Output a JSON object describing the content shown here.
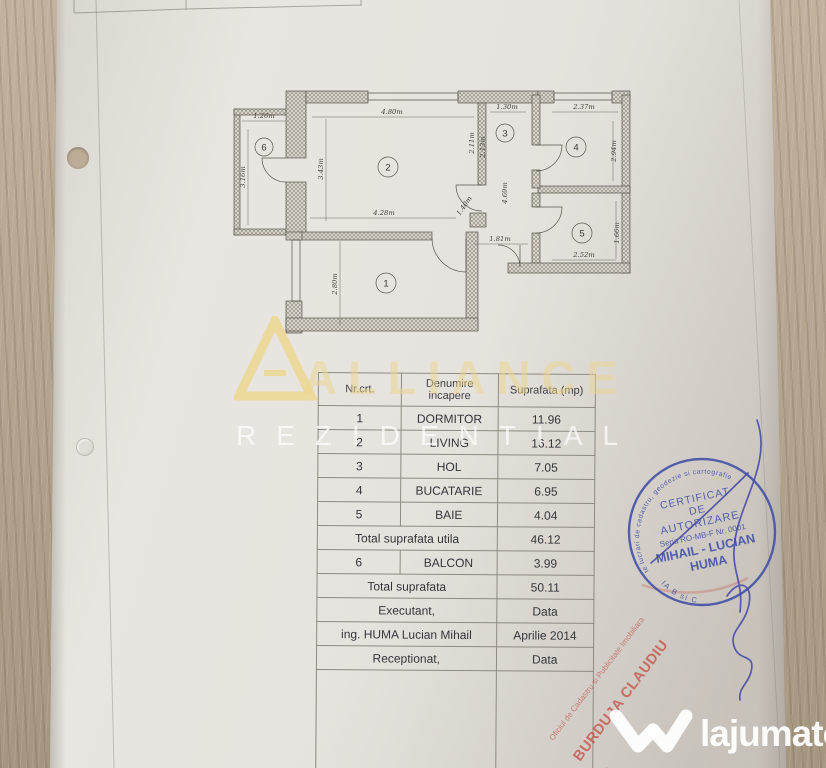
{
  "plan": {
    "rooms": [
      {
        "number": "1"
      },
      {
        "number": "2"
      },
      {
        "number": "3"
      },
      {
        "number": "4"
      },
      {
        "number": "5"
      },
      {
        "number": "6"
      }
    ],
    "dims": [
      {
        "label": "1.26m"
      },
      {
        "label": "3.16m"
      },
      {
        "label": "4.80m"
      },
      {
        "label": "3.43m"
      },
      {
        "label": "1.30m"
      },
      {
        "label": "2.11m"
      },
      {
        "label": "2.13m"
      },
      {
        "label": "2.37m"
      },
      {
        "label": "2.94m"
      },
      {
        "label": "1.40m"
      },
      {
        "label": "4.69m"
      },
      {
        "label": "4.28m"
      },
      {
        "label": "1.81m"
      },
      {
        "label": "2.52m"
      },
      {
        "label": "1.66m"
      },
      {
        "label": "2.80m"
      }
    ]
  },
  "table": {
    "headers": {
      "nr": "Nr.crt.",
      "name": "Denumire incapere",
      "area": "Suprafata (mp)"
    },
    "rows": [
      {
        "nr": "1",
        "name": "DORMITOR",
        "area": "11.96"
      },
      {
        "nr": "2",
        "name": "LIVING",
        "area": "16.12"
      },
      {
        "nr": "3",
        "name": "HOL",
        "area": "7.05"
      },
      {
        "nr": "4",
        "name": "BUCATARIE",
        "area": "6.95"
      },
      {
        "nr": "5",
        "name": "BAIE",
        "area": "4.04"
      }
    ],
    "total_utila": {
      "label": "Total suprafata utila",
      "value": "46.12"
    },
    "balcon_row": {
      "nr": "6",
      "name": "BALCON",
      "area": "3.99"
    },
    "total": {
      "label": "Total suprafata",
      "value": "50.11"
    },
    "executant": {
      "label": "Executant,",
      "value": "Data"
    },
    "engineer": {
      "label": "ing. HUMA Lucian Mihail",
      "value": "Aprilie 2014"
    },
    "receptionat": {
      "label": "Receptionat,",
      "value": "Data"
    }
  },
  "stamp": {
    "title1": "CERTIFICAT",
    "title2": "DE",
    "title3": "AUTORIZARE",
    "seria": "Seria RO-MB-F Nr. 0001",
    "name_line1": "MIHAIL - LUCIAN",
    "name_line2": "HUMA",
    "rim_text": "Persoana fizica autorizata de ANCPI sa execute lucrari de cadastru, geodezie si cartografie",
    "category": "CATEGORIA B si C",
    "color": "#4150a4"
  },
  "red_stamp": {
    "office_line": "Oficiul de Cadastru si Publicitate Imobiliara",
    "name_line": "BURDUJA CLAUDIU",
    "fragment": "dilier",
    "color": "#c2483f"
  },
  "watermarks": {
    "brand_word": "ALLIANCE",
    "brand_word2": "REZIDENTIAL",
    "brand_color": "#ecd68b",
    "site_name": "lajumate",
    "site_tld": ".ro",
    "site_accent": "#72cdc6"
  }
}
